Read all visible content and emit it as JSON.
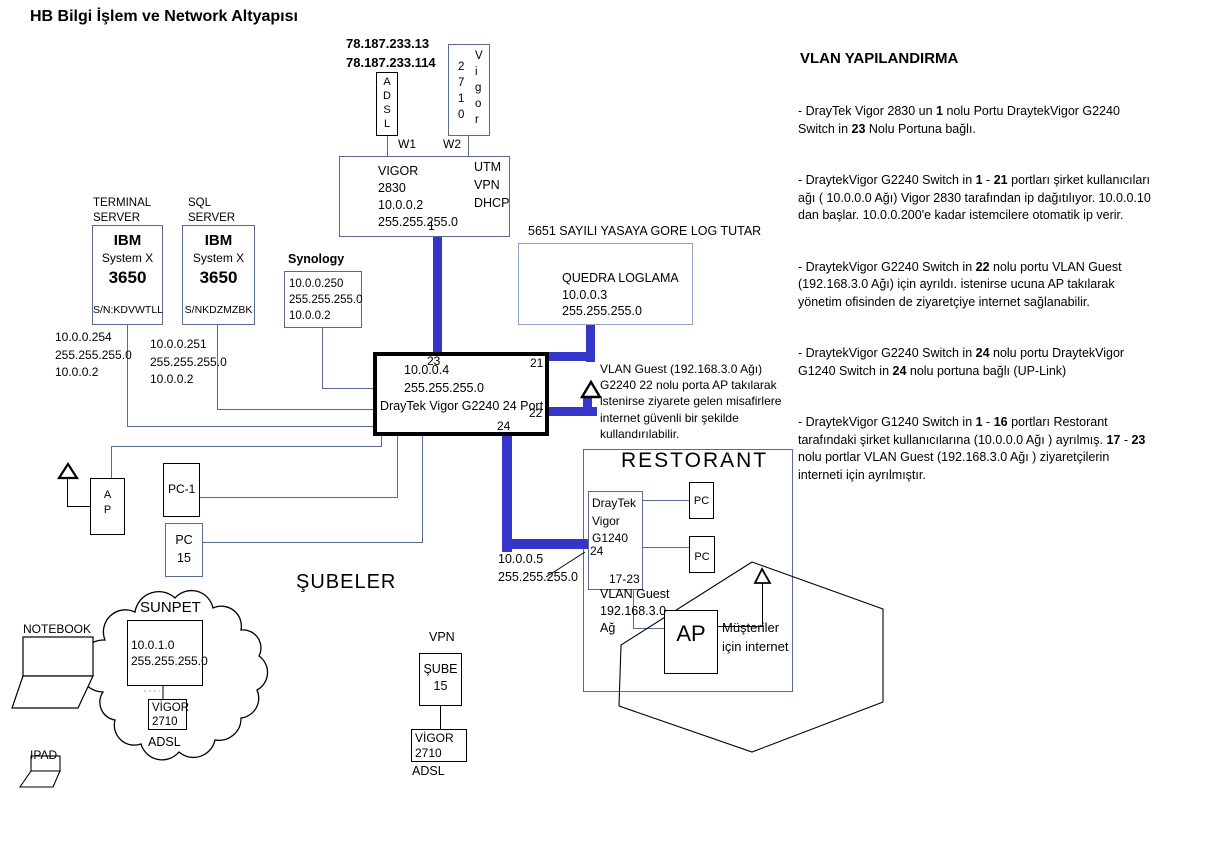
{
  "title": "HB Bilgi İşlem ve Network Altyapısı",
  "colors": {
    "trunk_blue": "#3535c8",
    "connector": "#5a6a8c"
  },
  "wan": {
    "public_ips": "78.187.233.13\n78.187.233.114",
    "adsl_stack": "A\nD\nS\nL",
    "modem_digits": "2\n7\n1\n0",
    "modem_brand": "V\ni\ng\no\nr",
    "w1": "W1",
    "w2": "W2"
  },
  "router_2830": {
    "info": "VIGOR\n2830\n10.0.0.2\n255.255.255.0",
    "features": "UTM\nVPN\nDHCP",
    "port_1": "1"
  },
  "logging": {
    "law_note": "5651 SAYILI YASAYA GORE LOG TUTAR",
    "quedra_info": "QUEDRA  LOGLAMA\n10.0.0.3\n255.255.255.0"
  },
  "terminal_server": {
    "label": "TERMINAL\nSERVER",
    "brand": "IBM",
    "series": "System X",
    "model": "3650",
    "serial": "S/N:KDVWTLL",
    "ips": "10.0.0.254\n255.255.255.0\n10.0.0.2"
  },
  "sql_server": {
    "label": "SQL\nSERVER",
    "brand": "IBM",
    "series": "System X",
    "model": "3650",
    "serial": "S/NKDZMZBK",
    "ips": "10.0.0.251\n255.255.255.0\n10.0.0.2"
  },
  "synology": {
    "label": "Synology",
    "info": "10.0.0.250\n255.255.255.0\n10.0.0.2"
  },
  "switch_g2240": {
    "ips": "10.0.0.4\n255.255.255.0",
    "name": "DrayTek Vigor G2240 24 Port",
    "port_23": "23",
    "port_21": "21",
    "port_22": "22",
    "port_24": "24"
  },
  "vlan_guest_note": "VLAN Guest (192.168.3.0 Ağı)\nG2240 22 nolu porta AP takılarak\nistenirse ziyarete gelen misafirlere\ninternet güvenli bir şekilde\nkullandırılabilir.",
  "uplink": {
    "ips": "10.0.0.5\n255.255.255.0"
  },
  "restorant": {
    "title": "RESTORANT",
    "g1240_name": "DrayTek\nVigor\nG1240",
    "g1240_port_24": "24",
    "g1240_ports_17_23": "17-23",
    "pc_top": "PC",
    "pc_bottom": "PC",
    "vlan_guest": "VLAN Guest\n192.168.3.0\nAğ",
    "ap": "AP",
    "customers_note": "Müşteriler\niçin internet"
  },
  "office": {
    "ap_stack": "A\nP",
    "pc1": "PC-1",
    "pc15": "PC\n15",
    "notebook": "NOTEBOOK",
    "ipad": "IPAD"
  },
  "subeler_label": "ŞUBELER",
  "sunpet": {
    "name": "SUNPET",
    "network": "10.0.1.0\n255.255.255.0",
    "modem": "VİGOR\n2710",
    "adsl": "ADSL"
  },
  "vpn_branch": {
    "vpn_label": "VPN",
    "sube": "ŞUBE\n15",
    "modem": "VİGOR\n2710",
    "adsl": "ADSL"
  },
  "vlan_panel": {
    "heading": "VLAN YAPILANDIRMA",
    "paragraphs": [
      "- DrayTek Vigor 2830 un **1** nolu Portu DraytekVigor G2240\nSwitch in **23** Nolu Portuna bağlı.",
      "- DraytekVigor G2240 Switch in  **1** - **21** portları şirket kullanıcıları\nağı ( 10.0.0.0 Ağı) Vigor 2830 tarafından ip dağıtılıyor. 10.0.0.10\ndan başlar. 10.0.0.200'e kadar istemcilere otomatik ip verir.",
      "- DraytekVigor G2240 Switch in **22** nolu portu VLAN Guest\n(192.168.3.0 Ağı) için ayrıldı. istenirse ucuna AP takılarak\nyönetim ofisinden de ziyaretçiye internet sağlanabilir.",
      "- DraytekVigor G2240 Switch in  **24** nolu portu DraytekVigor\nG1240 Switch in  **24** nolu portuna bağlı (UP-Link)",
      " - DraytekVigor G1240 Switch in **1** - **16** portları Restorant\ntarafındaki şirket kullanıcılarına (10.0.0.0 Ağı ) ayrılmış. **17** - **23**\nnolu portlar VLAN Guest (192.168.3.0 Ağı ) ziyaretçilerin\ninterneti için ayrılmıştır."
    ]
  }
}
